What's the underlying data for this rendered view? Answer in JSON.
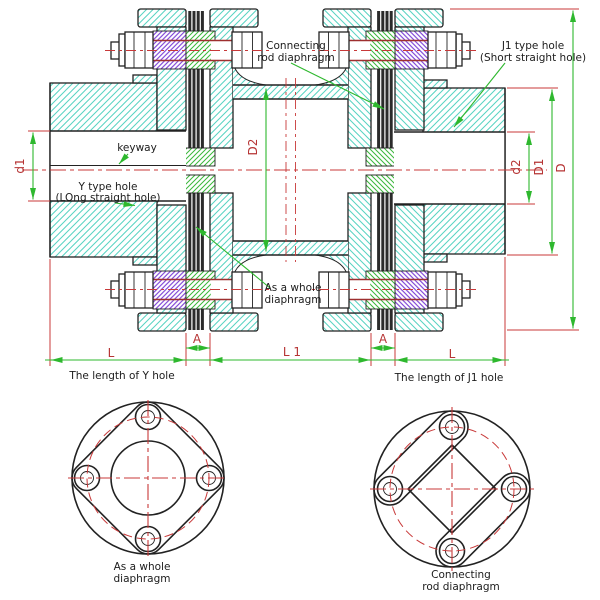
{
  "colors": {
    "outline": "#222222",
    "centerline_red": "#c83939",
    "dimension_green": "#2eb82e",
    "label_red": "#b63434",
    "hatch_cyan": "#57d3c2",
    "hatch_green": "#3bb83b",
    "hatch_purple": "#7b3fd6",
    "diaphragm_dark": "#2b2b2b"
  },
  "main_view": {
    "callouts": {
      "keyway": "keyway",
      "y_hole_line1": "Y type hole",
      "y_hole_line2": "(LOng straight hole)",
      "j1_hole_line1": "J1 type hole",
      "j1_hole_line2": "(Short straight hole)",
      "connecting_line1": "Connecting",
      "connecting_line2": "rod diaphragm",
      "whole_line1": "As a whole",
      "whole_line2": "diaphragm"
    },
    "dimensions": {
      "bore_left": "d1",
      "spacer_od": "D2",
      "bore_right": "d2",
      "hub_od": "D1",
      "flange_od": "D",
      "hub_len_left": "L",
      "gap_left": "A",
      "middle_len": "L 1",
      "gap_right": "A",
      "hub_len_right": "L"
    },
    "notes": {
      "length_y": "The length of Y hole",
      "length_j1": "The length of J1 hole"
    }
  },
  "end_views": {
    "left": {
      "caption_line1": "As a whole",
      "caption_line2": "diaphragm"
    },
    "right": {
      "caption_line1": "Connecting",
      "caption_line2": "rod diaphragm"
    }
  }
}
